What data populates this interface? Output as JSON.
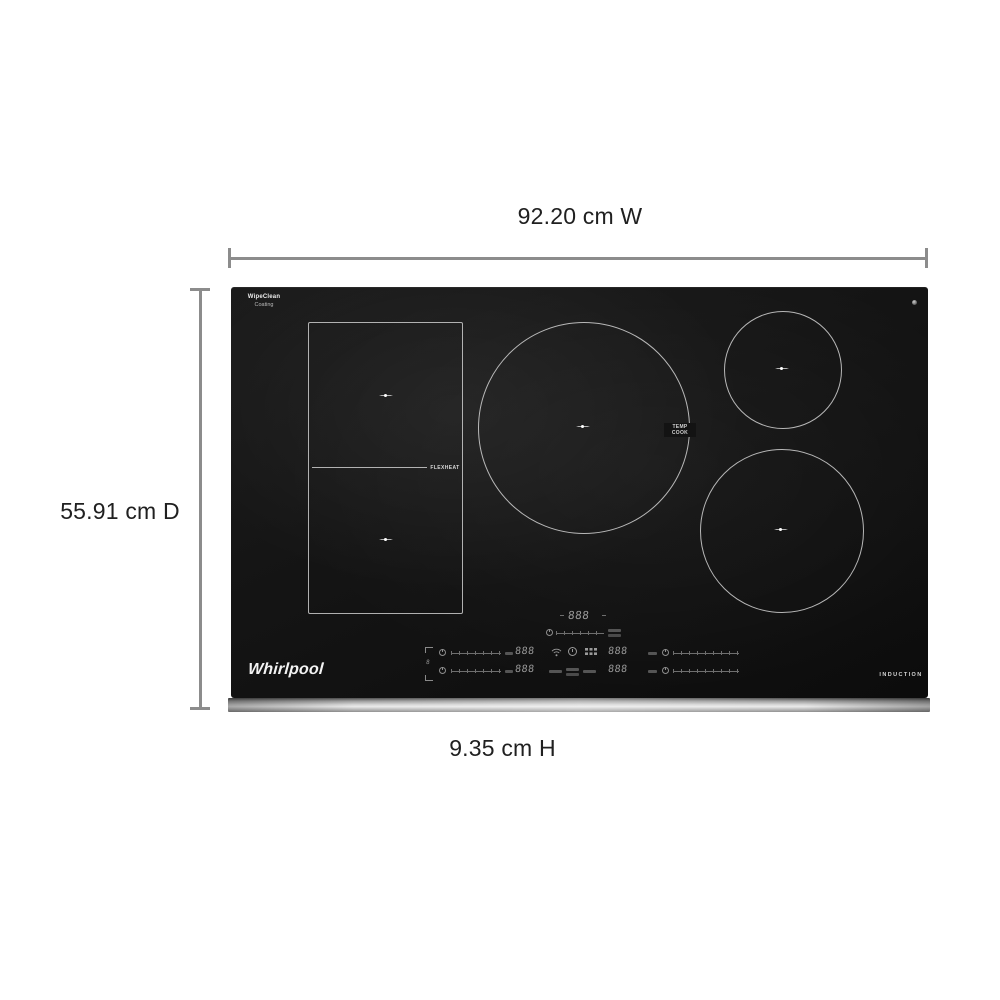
{
  "diagram": {
    "width_label": "92.20 cm W",
    "depth_label": "55.91 cm D",
    "height_label": "9.35 cm H"
  },
  "cooktop": {
    "brand": "Whirlpool",
    "badge": {
      "line1": "WipeClean",
      "line2": "Coating"
    },
    "flexheat_label": "FLEXHEAT",
    "temp_cook_label": "TEMP COOK",
    "induction_label": "INDUCTION",
    "flex_link_digit": "8",
    "displays": {
      "center": "888",
      "left_top": "888",
      "left_bottom": "888",
      "right_top": "888",
      "right_bottom": "888"
    },
    "icons": {
      "wifi": "wifi-icon",
      "power": "power-icon",
      "keypad": "keypad-icon",
      "screw": "screw-dot-icon"
    }
  },
  "colors": {
    "background": "#ffffff",
    "dimension_line": "#8c8c8c",
    "label_text": "#202020",
    "cooktop_black": "#121212",
    "burner_outline": "#d4d4d4",
    "steel_trim": "#c8c8c8",
    "control_gray": "#9b9b9b"
  }
}
